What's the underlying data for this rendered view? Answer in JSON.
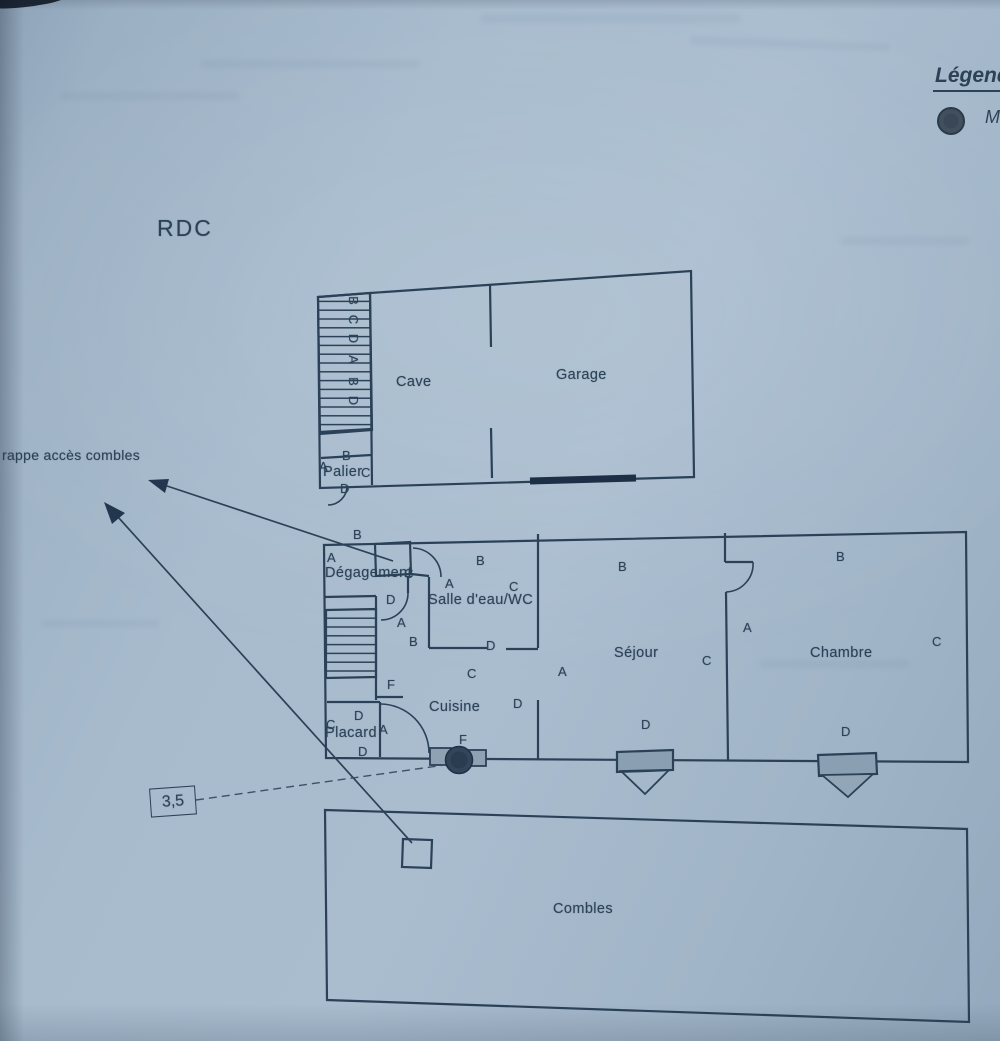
{
  "floor_label": "RDC",
  "legend": {
    "title": "Légende",
    "symbol": "filled-circle",
    "item_label_fragment": "M"
  },
  "callouts": {
    "trappe": "rappe accès combles",
    "dimension": "3,5"
  },
  "ink_color": "#2b4157",
  "paper_color": "#a3b7ca",
  "plans_labels": {
    "rooms": [
      {
        "name": "Cave",
        "x": 396,
        "y": 374
      },
      {
        "name": "Garage",
        "x": 556,
        "y": 367
      },
      {
        "name": "Palier",
        "x": 323,
        "y": 464
      },
      {
        "name": "Dégagement",
        "x": 325,
        "y": 565
      },
      {
        "name": "Salle d'eau/WC",
        "x": 428,
        "y": 592
      },
      {
        "name": "Cuisine",
        "x": 429,
        "y": 699
      },
      {
        "name": "Placard",
        "x": 325,
        "y": 725
      },
      {
        "name": "Séjour",
        "x": 614,
        "y": 645
      },
      {
        "name": "Chambre",
        "x": 810,
        "y": 645
      },
      {
        "name": "Combles",
        "x": 553,
        "y": 901
      }
    ],
    "letters": [
      {
        "t": "B",
        "x": 349,
        "y": 293,
        "rot": 90
      },
      {
        "t": "C",
        "x": 349,
        "y": 312,
        "rot": 90
      },
      {
        "t": "D",
        "x": 349,
        "y": 331,
        "rot": 90
      },
      {
        "t": "A",
        "x": 349,
        "y": 352,
        "rot": 90
      },
      {
        "t": "B",
        "x": 349,
        "y": 374,
        "rot": 90
      },
      {
        "t": "D",
        "x": 349,
        "y": 393,
        "rot": 90
      },
      {
        "t": "B",
        "x": 342,
        "y": 448
      },
      {
        "t": "A",
        "x": 319,
        "y": 459
      },
      {
        "t": "C",
        "x": 361,
        "y": 465
      },
      {
        "t": "D",
        "x": 340,
        "y": 481
      },
      {
        "t": "B",
        "x": 353,
        "y": 527
      },
      {
        "t": "A",
        "x": 327,
        "y": 550
      },
      {
        "t": "C",
        "x": 404,
        "y": 566
      },
      {
        "t": "D",
        "x": 386,
        "y": 592
      },
      {
        "t": "A",
        "x": 397,
        "y": 615
      },
      {
        "t": "B",
        "x": 409,
        "y": 634
      },
      {
        "t": "B",
        "x": 476,
        "y": 553
      },
      {
        "t": "A",
        "x": 445,
        "y": 576
      },
      {
        "t": "C",
        "x": 509,
        "y": 579
      },
      {
        "t": "D",
        "x": 486,
        "y": 638
      },
      {
        "t": "F",
        "x": 387,
        "y": 677
      },
      {
        "t": "C",
        "x": 467,
        "y": 666
      },
      {
        "t": "D",
        "x": 513,
        "y": 696
      },
      {
        "t": "D",
        "x": 354,
        "y": 708
      },
      {
        "t": "C",
        "x": 326,
        "y": 717
      },
      {
        "t": "A",
        "x": 379,
        "y": 722
      },
      {
        "t": "D",
        "x": 358,
        "y": 744
      },
      {
        "t": "F",
        "x": 459,
        "y": 732
      },
      {
        "t": "B",
        "x": 618,
        "y": 559
      },
      {
        "t": "A",
        "x": 558,
        "y": 664
      },
      {
        "t": "C",
        "x": 702,
        "y": 653
      },
      {
        "t": "D",
        "x": 641,
        "y": 717
      },
      {
        "t": "B",
        "x": 836,
        "y": 549
      },
      {
        "t": "A",
        "x": 743,
        "y": 620
      },
      {
        "t": "C",
        "x": 932,
        "y": 634
      },
      {
        "t": "D",
        "x": 841,
        "y": 724
      }
    ]
  }
}
